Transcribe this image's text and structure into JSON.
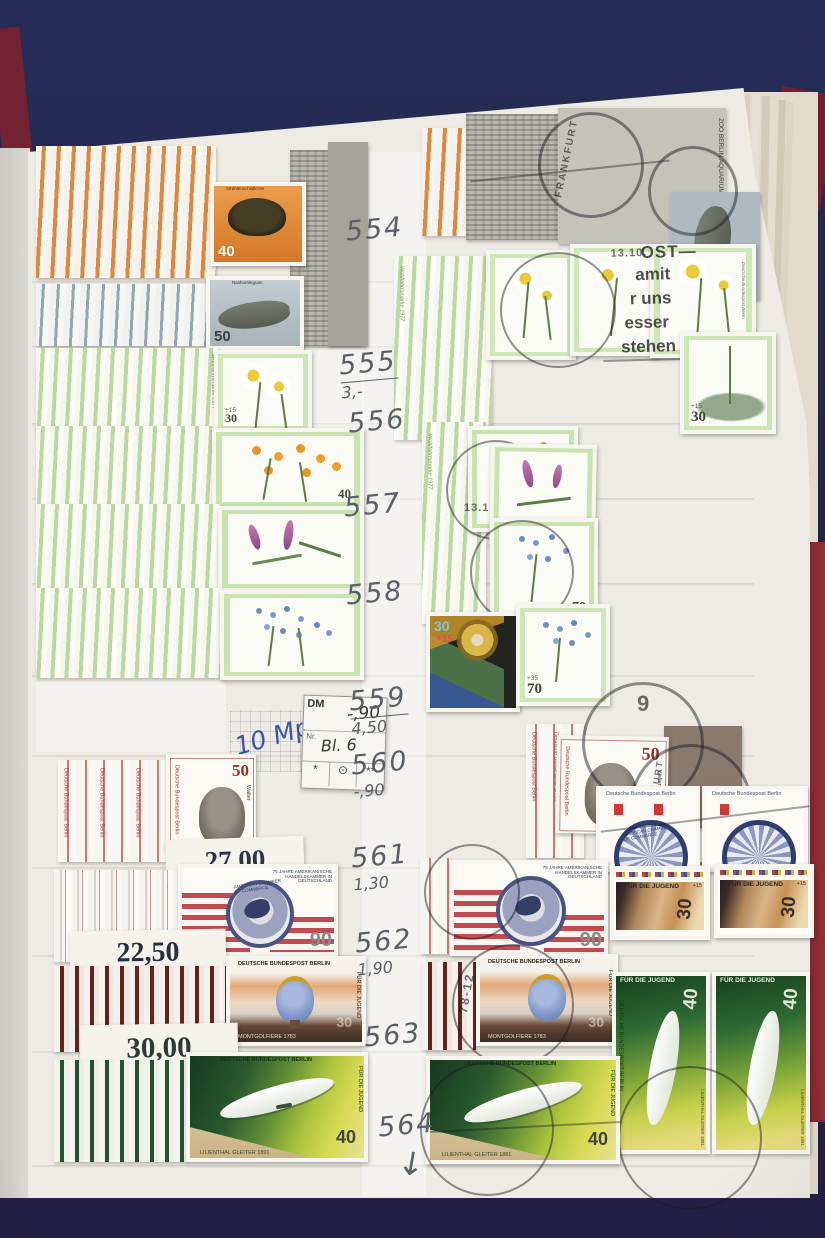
{
  "annotations": {
    "gutter": [
      {
        "n": "554",
        "p": ""
      },
      {
        "n": "555",
        "p": "3,-"
      },
      {
        "n": "556",
        "p": ""
      },
      {
        "n": "557",
        "p": ""
      },
      {
        "n": "558",
        "p": ""
      },
      {
        "n": "559",
        "p": "4,50"
      },
      {
        "n": "560",
        "p": "-,90"
      },
      {
        "n": "561",
        "p": "1,30"
      },
      {
        "n": "562",
        "p": "1,90"
      },
      {
        "n": "563",
        "p": ""
      },
      {
        "n": "564",
        "p": ""
      }
    ],
    "arrow": "↓",
    "note_blue": "10 Mp"
  },
  "dealer_label": {
    "currency": "DM",
    "price": "-,90",
    "nr_label": "Nr.",
    "nr_value": "Bl. 6",
    "sym1": "*",
    "sym2": "⊙",
    "sym3": "**"
  },
  "price_tags": [
    "27,00",
    "22,50",
    "30,00"
  ],
  "stamps": {
    "bund": "DEUTSCHE BUNDESPOST BERLIN",
    "bund_short": "DEUTSCHE BUNDESP",
    "jugend": "FÜR DIE JUGEND",
    "script": "Deutsche Bundespost Berlin",
    "wohlfahrt": "Wohlfahrtsmarke 1977",
    "zoo": "ZOO BERLIN AQUARIUM",
    "turtle": {
      "value": "40",
      "title": "Strahlenschildkröte"
    },
    "iguana": {
      "value": "50",
      "title": "Nashornleguan"
    },
    "daisy": {
      "value": "30",
      "sur": "+15"
    },
    "buttercup": {
      "value": "40"
    },
    "forgetmenot": {
      "value": "70",
      "sur": "+35"
    },
    "christmas": {
      "value": "30",
      "sur": "+15"
    },
    "walter": {
      "value": "50",
      "name": "Walter"
    },
    "chamber": {
      "value": "90",
      "header": "75 JAHRE AMERIKANISCHE HANDELSKAMMER IN DEUTSCHLAND",
      "seal": "AMERICAN CHAMBER OF COMMERCE"
    },
    "balloon": {
      "value": "30",
      "title": "MONTGOLFIERE 1783"
    },
    "glider": {
      "value": "40",
      "title": "LILIENTHAL GLEITER 1891"
    },
    "jugend30": {
      "value": "30",
      "sur": "+15"
    }
  },
  "postmarks": {
    "city": "FRANKFURT",
    "date": "13.10.",
    "code": "78-12",
    "digit": "9",
    "slogan1": "OST—",
    "slogan2": "amit",
    "slogan3": "r uns",
    "slogan4": "esser",
    "slogan5": "stehen"
  }
}
